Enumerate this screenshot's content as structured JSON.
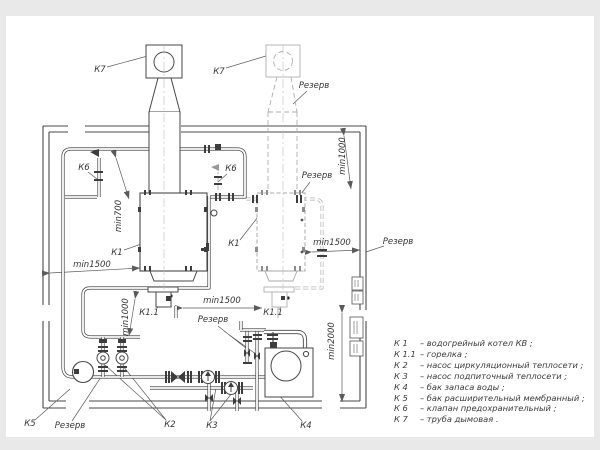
{
  "colors": {
    "paper": "#ffffff",
    "matte": "#e9e9e9",
    "line": "#474747",
    "reserve_line": "#b0b0b0",
    "dim_line": "#5a5a5a",
    "text": "#353535"
  },
  "labels": [
    {
      "name": "label-k7-left",
      "text": "К7",
      "x": 100,
      "y": 70,
      "rot": 0
    },
    {
      "name": "label-k7-right",
      "text": "К7",
      "x": 219,
      "y": 72,
      "rot": 0
    },
    {
      "name": "label-rezerv-chimney",
      "text": "Резерв",
      "x": 314,
      "y": 86,
      "rot": 0
    },
    {
      "name": "label-k6-left",
      "text": "К6",
      "x": 84,
      "y": 168,
      "rot": 0
    },
    {
      "name": "label-k6-right",
      "text": "К6",
      "x": 231,
      "y": 169,
      "rot": 0
    },
    {
      "name": "label-min700",
      "text": "min700",
      "x": 119,
      "y": 216,
      "rot": -90
    },
    {
      "name": "label-k1-left",
      "text": "К1",
      "x": 117,
      "y": 253,
      "rot": 0
    },
    {
      "name": "label-min1500-left",
      "text": "min1500",
      "x": 92,
      "y": 265,
      "rot": 0
    },
    {
      "name": "label-min1000-left",
      "text": "min1000",
      "x": 126,
      "y": 317,
      "rot": -90
    },
    {
      "name": "label-k11-left",
      "text": "К1.1",
      "x": 149,
      "y": 313,
      "rot": 0
    },
    {
      "name": "label-min1500-center",
      "text": "min1500",
      "x": 222,
      "y": 301,
      "rot": 0
    },
    {
      "name": "label-rezerv-center",
      "text": "Резерв",
      "x": 213,
      "y": 320,
      "rot": 0
    },
    {
      "name": "label-k11-right",
      "text": "К1.1",
      "x": 273,
      "y": 313,
      "rot": 0
    },
    {
      "name": "label-k1-right",
      "text": "К1",
      "x": 234,
      "y": 244,
      "rot": 0
    },
    {
      "name": "label-min1500-right",
      "text": "min1500",
      "x": 332,
      "y": 243,
      "rot": 0
    },
    {
      "name": "label-rezerv-pipe",
      "text": "Резерв",
      "x": 317,
      "y": 176,
      "rot": 0
    },
    {
      "name": "label-min1000-right",
      "text": "min1000",
      "x": 343,
      "y": 156,
      "rot": -90
    },
    {
      "name": "label-rezerv-wall",
      "text": "Резерв",
      "x": 398,
      "y": 242,
      "rot": 0
    },
    {
      "name": "label-min2000",
      "text": "min2000",
      "x": 332,
      "y": 341,
      "rot": -90
    },
    {
      "name": "label-k5",
      "text": "К5",
      "x": 30,
      "y": 424,
      "rot": 0
    },
    {
      "name": "label-rezerv-pump",
      "text": "Резерв",
      "x": 70,
      "y": 426,
      "rot": 0
    },
    {
      "name": "label-k2",
      "text": "К2",
      "x": 170,
      "y": 425,
      "rot": 0
    },
    {
      "name": "label-k3",
      "text": "К3",
      "x": 212,
      "y": 426,
      "rot": 0
    },
    {
      "name": "label-k4",
      "text": "К4",
      "x": 306,
      "y": 426,
      "rot": 0
    }
  ],
  "legend": {
    "items": [
      {
        "key": "К 1",
        "desc": "–  водогрейный котел КВ ;"
      },
      {
        "key": "К 1.1",
        "desc": "–  горелка ;"
      },
      {
        "key": "К 2",
        "desc": "–  насос циркуляционный теплосети ;"
      },
      {
        "key": "К 3",
        "desc": "–  насос подпиточный теплосети ;"
      },
      {
        "key": "К 4",
        "desc": "–  бак запаса воды ;"
      },
      {
        "key": "К 5",
        "desc": "–  бак расширительный мембранный ;"
      },
      {
        "key": "К 6",
        "desc": "–  клапан предохранительный ;"
      },
      {
        "key": "К 7",
        "desc": "–  труба дымовая ."
      }
    ]
  }
}
